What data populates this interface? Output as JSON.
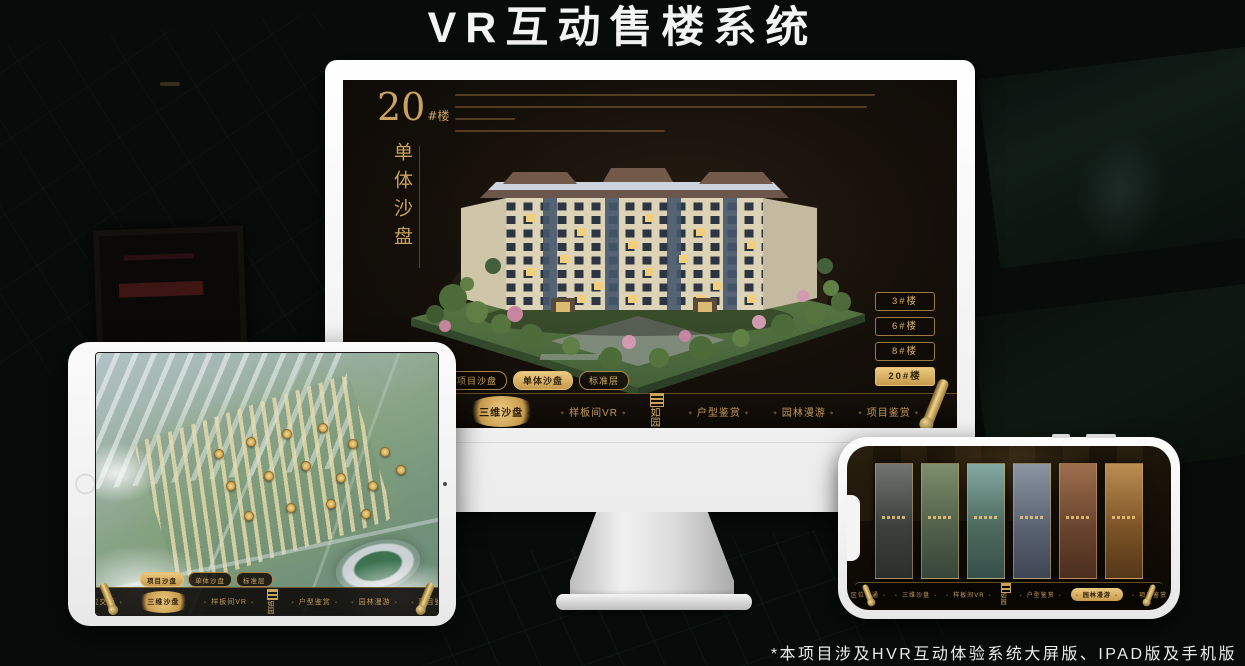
{
  "page": {
    "title": "VR互动售楼系统",
    "footnote": "*本项目涉及HVR互动体验系统大屏版、IPAD版及手机版"
  },
  "brand": {
    "logo_text": "如园",
    "logo_icon": "seal-icon"
  },
  "colors": {
    "gold": "#cfa95f",
    "gold_active_bg": "#d9b269",
    "active_text": "#33230b",
    "screen_bg": "#16110c",
    "title_text": "#f4f4f4"
  },
  "shared_nav": {
    "view_tabs": [
      {
        "label": "项目沙盘"
      },
      {
        "label": "单体沙盘"
      },
      {
        "label": "标准层"
      }
    ],
    "items": [
      "区位交通",
      "三维沙盘",
      "样板间VR",
      "户型鉴赏",
      "园林漫游",
      "项目鉴赏"
    ]
  },
  "desktop": {
    "active_view_tab": "单体沙盘",
    "active_nav_item": "三维沙盘",
    "building_title": {
      "number": "20",
      "unit": "#楼",
      "subtitle": "单体沙盘"
    },
    "floor_buttons": [
      {
        "label": "3#楼",
        "active": false
      },
      {
        "label": "6#楼",
        "active": false
      },
      {
        "label": "8#楼",
        "active": false
      },
      {
        "label": "20#楼",
        "active": true
      }
    ]
  },
  "tablet": {
    "active_view_tab": "项目沙盘",
    "active_nav_item": "三维沙盘"
  },
  "phone": {
    "active_nav_item": "园林漫游"
  }
}
